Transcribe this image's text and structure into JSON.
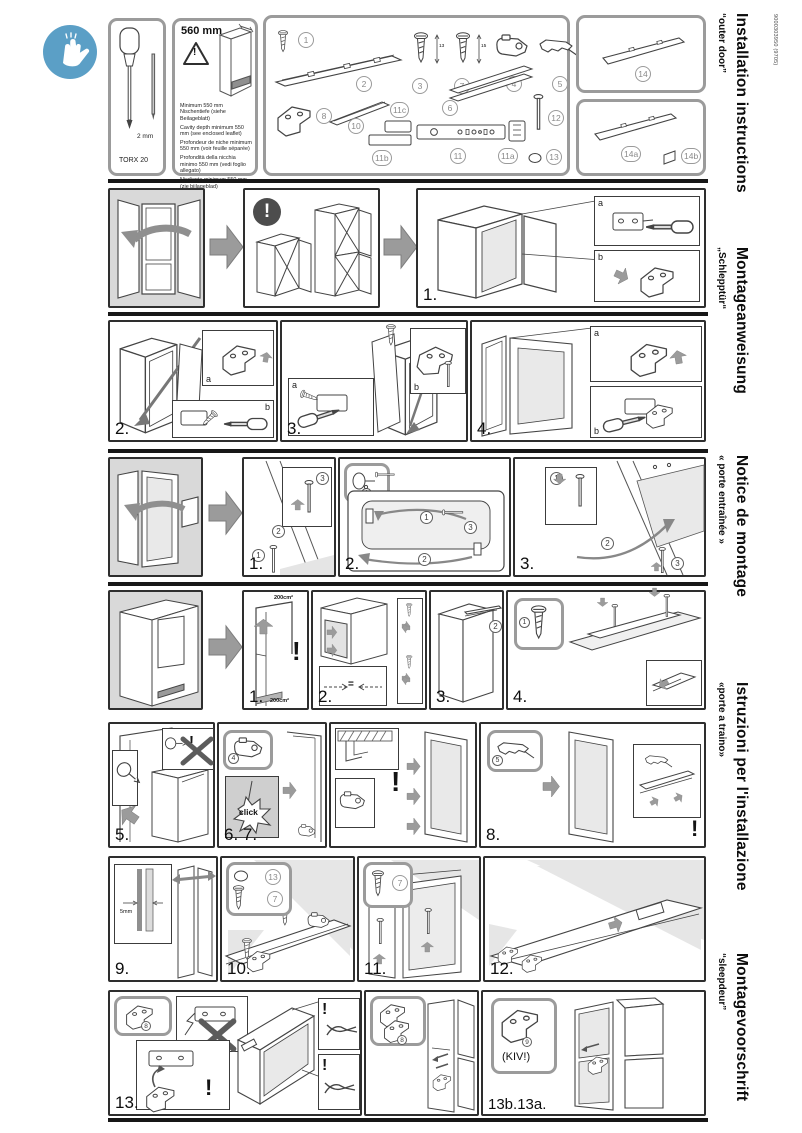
{
  "doc": {
    "number": "9000303950 (9705)"
  },
  "symbols": {
    "warn": "!"
  },
  "header": {
    "tools": {
      "torx": "TORX 20",
      "bit": "2 mm"
    },
    "niche": {
      "width": "560 mm",
      "notes": [
        "Minimum 550 mm Nischentiefe (siehe Beilageblatt)",
        "Cavity depth minimum 550 mm (see enclosed leaflet)",
        "Profondeur de niche minimum 550 mm (voir feuille séparée)",
        "Profondità della nicchia minimo 550 mm (vedi foglio allegato)",
        "Nisdiepte minimum 550 mm (zie bijlageblad)"
      ]
    },
    "parts": {
      "c1": "1",
      "c2": "2",
      "c3": "3",
      "c4": "4",
      "c5": "5",
      "c6": "6",
      "c7": "7",
      "c8": "8",
      "c10": "10",
      "c11": "11",
      "c11a": "11a",
      "c11b": "11b",
      "c11c": "11c",
      "c12": "12",
      "c13": "13",
      "screw3_len": "13",
      "screw7_len": "15",
      "c14": "14",
      "c14a": "14a",
      "c14b": "14b"
    }
  },
  "steps": {
    "s1": "1.",
    "s2": "2.",
    "s3": "3.",
    "s4": "4.",
    "s5": "5.",
    "s67": "6. 7.",
    "s8": "8.",
    "s9": "9.",
    "s10": "10.",
    "s11": "11.",
    "s12": "12.",
    "s13": "13.",
    "s13ba": "13b.13a."
  },
  "annotations": {
    "a": "a",
    "b": "b",
    "click": "click",
    "gap": "5mm",
    "kiv": "(KIV!)",
    "n1": "1",
    "n2": "2",
    "n3": "3",
    "p4": "4",
    "p5": "5",
    "p7": "7",
    "p8": "8",
    "p9": "9",
    "p13": "13",
    "vent": "200cm²",
    "equal": "="
  },
  "sidebar": {
    "sections": [
      {
        "title": "Installation instructions",
        "subtitle": "“outer door”"
      },
      {
        "title": "Montageanweisung",
        "subtitle": "„Schlepptür“"
      },
      {
        "title": "Notice de montage",
        "subtitle": "« porte entraînée »"
      },
      {
        "title": "Istruzioni per l'installazione",
        "subtitle": "«porte a traino»"
      },
      {
        "title": "Montagevoorschrift",
        "subtitle": "“sleepdeur”"
      }
    ]
  }
}
